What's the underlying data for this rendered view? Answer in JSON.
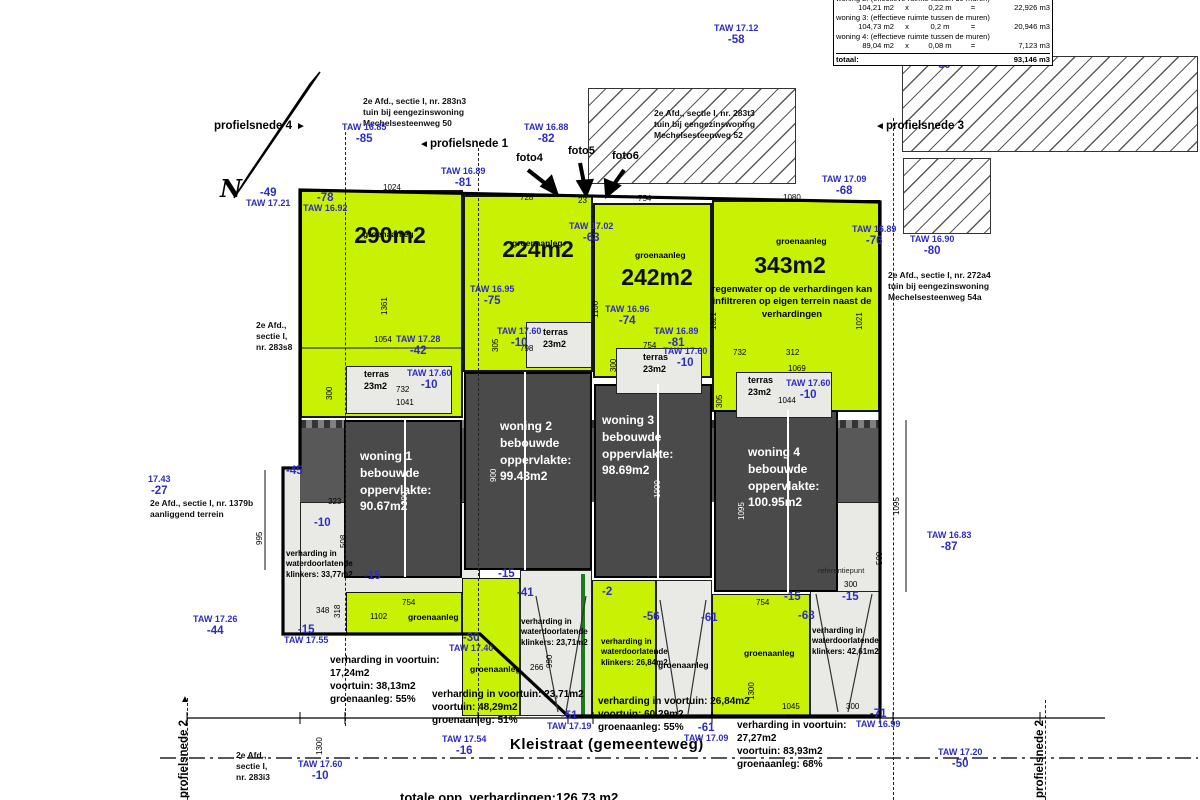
{
  "colors": {
    "parcel_green": "#c9f104",
    "building_gray": "#4a4a4a",
    "light_gray": "#e9e9e6",
    "annotation_blue": "#2d2dc2"
  },
  "summary_table": {
    "rows": [
      {
        "label": "woning 2:  (effectieve ruimte tussen de muren)"
      },
      {
        "a": "104,21 m2",
        "op": "x",
        "b": "0,22 m",
        "eq": "=",
        "v": "22,926 m3"
      },
      {
        "label": "woning 3:  (effectieve ruimte tussen de muren)"
      },
      {
        "a": "104,73 m2",
        "op": "x",
        "b": "0,2 m",
        "eq": "=",
        "v": "20,946 m3"
      },
      {
        "label": "woning 4:  (effectieve ruimte tussen de muren)"
      },
      {
        "a": "89,04 m2",
        "op": "x",
        "b": "0,08 m",
        "eq": "=",
        "v": "7,123 m3"
      }
    ],
    "total_label": "totaal:",
    "total_value": "93,146 m3"
  },
  "parcels": [
    {
      "label": "groenaanleg",
      "area": "290m2",
      "lx": 363,
      "ly": 229,
      "ax": 390,
      "ay": 222
    },
    {
      "label": "groenaanleg",
      "area": "224m2",
      "lx": 512,
      "ly": 238,
      "ax": 538,
      "ay": 236
    },
    {
      "label": "groenaanleg",
      "area": "242m2",
      "lx": 635,
      "ly": 250,
      "ax": 657,
      "ay": 264
    },
    {
      "label": "groenaanleg",
      "area": "343m2",
      "lx": 776,
      "ly": 236,
      "ax": 790,
      "ay": 252,
      "note": "regenwater op de verhardingen kan infiltreren op eigen terrein naast de verhardingen",
      "nx": 792,
      "ny": 284
    }
  ],
  "buildings": [
    {
      "lines": [
        "woning 1",
        "bebouwde",
        "oppervlakte:",
        "90.67m2"
      ],
      "tx": 360,
      "ty": 448
    },
    {
      "lines": [
        "woning 2",
        "bebouwde",
        "oppervlakte:",
        "99.43m2"
      ],
      "tx": 500,
      "ty": 418
    },
    {
      "lines": [
        "woning 3",
        "bebouwde",
        "oppervlakte:",
        "98.69m2"
      ],
      "tx": 602,
      "ty": 412
    },
    {
      "lines": [
        "woning 4",
        "bebouwde",
        "oppervlakte:",
        "100.95m2"
      ],
      "tx": 748,
      "ty": 444
    }
  ],
  "terraces": [
    {
      "label": "terras",
      "area": "23m2",
      "x": 364,
      "y": 368
    },
    {
      "label": "terras",
      "area": "23m2",
      "x": 543,
      "y": 326
    },
    {
      "label": "terras",
      "area": "23m2",
      "x": 643,
      "y": 351
    },
    {
      "label": "terras",
      "area": "23m2",
      "x": 748,
      "y": 374
    }
  ],
  "taw_markers": [
    {
      "taw": "TAW 17.12",
      "off": "-58",
      "x": 714,
      "y": 24
    },
    {
      "taw": "TAW 16.85",
      "off": "-85",
      "x": 342,
      "y": 123
    },
    {
      "taw": "TAW 16.88",
      "off": "-82",
      "x": 524,
      "y": 123
    },
    {
      "taw": "TAW 16.89",
      "off": "-81",
      "x": 441,
      "y": 167
    },
    {
      "taw": "TAW 17.21",
      "off": "-49",
      "x": 246,
      "y": 187,
      "flip": true
    },
    {
      "taw": "TAW 16.92",
      "off": "-78",
      "x": 303,
      "y": 192,
      "flip": true
    },
    {
      "taw": "TAW 17.09",
      "off": "-68",
      "x": 822,
      "y": 175
    },
    {
      "taw": "TAW 16.89",
      "off": "-76",
      "x": 852,
      "y": 225
    },
    {
      "taw": "TAW 16.90",
      "off": "-80",
      "x": 910,
      "y": 235
    },
    {
      "taw": "TAW 16.95",
      "off": "-75",
      "x": 470,
      "y": 285
    },
    {
      "taw": "TAW 17.02",
      "off": "-63",
      "x": 569,
      "y": 222
    },
    {
      "taw": "TAW 16.96",
      "off": "-74",
      "x": 605,
      "y": 305
    },
    {
      "taw": "TAW 16.89",
      "off": "-81",
      "x": 654,
      "y": 327
    },
    {
      "taw": "TAW 17.28",
      "off": "-42",
      "x": 396,
      "y": 335
    },
    {
      "taw": "17.43",
      "off": "-27",
      "x": 148,
      "y": 475
    },
    {
      "taw": "TAW 17.26",
      "off": "-44",
      "x": 193,
      "y": 615
    },
    {
      "taw": "TAW 17.55",
      "off": "-15",
      "x": 284,
      "y": 624,
      "flip": true
    },
    {
      "taw": "TAW 17.40",
      "off": "-30",
      "x": 449,
      "y": 632,
      "flip": true
    },
    {
      "taw": "TAW 17.19",
      "off": "-51",
      "x": 547,
      "y": 710,
      "flip": true
    },
    {
      "taw": "TAW 17.09",
      "off": "-61",
      "x": 684,
      "y": 722,
      "flip": true
    },
    {
      "taw": "TAW 16.99",
      "off": "-71",
      "x": 856,
      "y": 708,
      "flip": true
    },
    {
      "taw": "TAW 17.54",
      "off": "-16",
      "x": 442,
      "y": 735
    },
    {
      "taw": "TAW 16.83",
      "off": "-87",
      "x": 927,
      "y": 531
    },
    {
      "taw": "TAW 17.20",
      "off": "-50",
      "x": 938,
      "y": 748
    },
    {
      "taw": "TAW 17.60",
      "off": "-10",
      "x": 298,
      "y": 760
    },
    {
      "taw": "TAW 17.60",
      "off": "-10",
      "x": 407,
      "y": 369
    },
    {
      "taw": "TAW 17.60",
      "off": "-10",
      "x": 497,
      "y": 327
    },
    {
      "taw": "TAW 17.60",
      "off": "-10",
      "x": 663,
      "y": 347
    },
    {
      "taw": "TAW 17.60",
      "off": "-10",
      "x": 786,
      "y": 379
    }
  ],
  "offset_markers": [
    {
      "t": "-60",
      "x": 934,
      "y": 60
    },
    {
      "t": "-45",
      "x": 286,
      "y": 466
    },
    {
      "t": "-10",
      "x": 314,
      "y": 518
    },
    {
      "t": "-15",
      "x": 364,
      "y": 571
    },
    {
      "t": "-15",
      "x": 498,
      "y": 569
    },
    {
      "t": "-41",
      "x": 517,
      "y": 588
    },
    {
      "t": "-2",
      "x": 602,
      "y": 587
    },
    {
      "t": "-56",
      "x": 643,
      "y": 612
    },
    {
      "t": "-61",
      "x": 701,
      "y": 613
    },
    {
      "t": "-15",
      "x": 784,
      "y": 592
    },
    {
      "t": "-68",
      "x": 798,
      "y": 611
    },
    {
      "t": "-15",
      "x": 842,
      "y": 592
    }
  ],
  "dims": [
    {
      "t": "1024",
      "x": 383,
      "y": 184
    },
    {
      "t": "728",
      "x": 520,
      "y": 194
    },
    {
      "t": "23",
      "x": 578,
      "y": 197
    },
    {
      "t": "754",
      "x": 638,
      "y": 195
    },
    {
      "t": "1080",
      "x": 783,
      "y": 194
    },
    {
      "t": "1361",
      "x": 381,
      "y": 315,
      "r": 1
    },
    {
      "t": "1100",
      "x": 592,
      "y": 318,
      "r": 1
    },
    {
      "t": "1321",
      "x": 710,
      "y": 330,
      "r": 1
    },
    {
      "t": "1021",
      "x": 856,
      "y": 330,
      "r": 1
    },
    {
      "t": "1054",
      "x": 374,
      "y": 336
    },
    {
      "t": "732",
      "x": 396,
      "y": 386
    },
    {
      "t": "300",
      "x": 326,
      "y": 400,
      "r": 1
    },
    {
      "t": "1041",
      "x": 396,
      "y": 399
    },
    {
      "t": "798",
      "x": 520,
      "y": 345
    },
    {
      "t": "305",
      "x": 492,
      "y": 352,
      "r": 1
    },
    {
      "t": "754",
      "x": 643,
      "y": 342
    },
    {
      "t": "300",
      "x": 610,
      "y": 372,
      "r": 1
    },
    {
      "t": "732",
      "x": 733,
      "y": 349
    },
    {
      "t": "312",
      "x": 786,
      "y": 349
    },
    {
      "t": "1069",
      "x": 788,
      "y": 365
    },
    {
      "t": "1044",
      "x": 778,
      "y": 397
    },
    {
      "t": "305",
      "x": 716,
      "y": 408,
      "r": 1
    },
    {
      "t": "323",
      "x": 328,
      "y": 498
    },
    {
      "t": "508",
      "x": 340,
      "y": 548,
      "r": 1
    },
    {
      "t": "318",
      "x": 334,
      "y": 618,
      "r": 1
    },
    {
      "t": "348",
      "x": 316,
      "y": 607
    },
    {
      "t": "995",
      "x": 256,
      "y": 545,
      "r": 1
    },
    {
      "t": "1102",
      "x": 370,
      "y": 613
    },
    {
      "t": "754",
      "x": 402,
      "y": 599
    },
    {
      "t": "266",
      "x": 530,
      "y": 664
    },
    {
      "t": "990",
      "x": 546,
      "y": 668,
      "r": 1
    },
    {
      "t": "754",
      "x": 756,
      "y": 599
    },
    {
      "t": "300",
      "x": 844,
      "y": 581
    },
    {
      "t": "1045",
      "x": 782,
      "y": 703
    },
    {
      "t": "300",
      "x": 846,
      "y": 703
    },
    {
      "t": "1300",
      "x": 748,
      "y": 700,
      "r": 1
    },
    {
      "t": "1300",
      "x": 316,
      "y": 755,
      "r": 1
    },
    {
      "t": "1095",
      "x": 893,
      "y": 515,
      "r": 1
    },
    {
      "t": "500",
      "x": 876,
      "y": 565,
      "r": 1
    },
    {
      "t": "990",
      "x": 401,
      "y": 505,
      "r": 1,
      "w": 1
    },
    {
      "t": "900",
      "x": 490,
      "y": 482,
      "r": 1,
      "w": 1
    },
    {
      "t": "1000",
      "x": 654,
      "y": 498,
      "r": 1,
      "w": 1
    },
    {
      "t": "1095",
      "x": 738,
      "y": 520,
      "r": 1,
      "w": 1
    }
  ],
  "cadastre": [
    {
      "lines": [
        "2e Afd., sectie I, nr. 283n3",
        "tuin bij eengezinswoning",
        "Mechelsesteenweg 50"
      ],
      "x": 363,
      "y": 96
    },
    {
      "lines": [
        "2e Afd., sectie I, nr. 283t3",
        "tuin bij eengezinswoning",
        "Mechelsesteenweg 52"
      ],
      "x": 654,
      "y": 108
    },
    {
      "lines": [
        "2e Afd., sectie I, nr. 272a4",
        "tuin bij eengezinswoning",
        "Mechelsesteenweg 54a"
      ],
      "x": 888,
      "y": 270
    },
    {
      "lines": [
        "2e Afd.,",
        "sectie I,",
        "nr. 283s8"
      ],
      "x": 256,
      "y": 320
    },
    {
      "lines": [
        "2e Afd., sectie I, nr. 1379b",
        "aanliggend terrein"
      ],
      "x": 150,
      "y": 498
    },
    {
      "lines": [
        "2e Afd.,",
        "sectie I,",
        "nr. 283i3"
      ],
      "x": 236,
      "y": 750
    }
  ],
  "notes": [
    {
      "lines": [
        "verharding in",
        "waterdoorlatende",
        "klinkers:  33,77m2"
      ],
      "x": 286,
      "y": 549,
      "s": 8
    },
    {
      "lines": [
        "verharding in voortuin:",
        "17,24m2",
        "voortuin:  38,13m2",
        "groenaanleg:  55%"
      ],
      "x": 330,
      "y": 654,
      "s": 10
    },
    {
      "lines": [
        "verharding in voortuin: 23,71m2",
        "voortuin:  48,29m2",
        "groenaanleg:  51%"
      ],
      "x": 432,
      "y": 688,
      "s": 10
    },
    {
      "lines": [
        "verharding in",
        "waterdoorlatende",
        "klinkers:  23,71m2"
      ],
      "x": 521,
      "y": 617,
      "s": 8
    },
    {
      "lines": [
        "verharding in",
        "waterdoorlatende",
        "klinkers:  26,84m2"
      ],
      "x": 601,
      "y": 637,
      "s": 8
    },
    {
      "lines": [
        "verharding in voortuin: 26,84m2",
        "voortuin:  60,29m2",
        "groenaanleg:  55%"
      ],
      "x": 598,
      "y": 695,
      "s": 10
    },
    {
      "lines": [
        "verharding in",
        "waterdoorlatende",
        "klinkers:  42,61m2"
      ],
      "x": 812,
      "y": 626,
      "s": 8
    },
    {
      "lines": [
        "verharding in voortuin:",
        "27,27m2",
        "voortuin:  83,93m2",
        "groenaanleg:  68%"
      ],
      "x": 737,
      "y": 719,
      "s": 10
    }
  ],
  "green_labels": [
    {
      "t": "groenaanleg",
      "x": 408,
      "y": 612
    },
    {
      "t": "groenaanleg",
      "x": 470,
      "y": 664
    },
    {
      "t": "groenaanleg",
      "x": 658,
      "y": 660
    },
    {
      "t": "groenaanleg",
      "x": 744,
      "y": 648
    }
  ],
  "profiles": [
    {
      "label": "profielsnede 4",
      "x": 214,
      "y": 120,
      "arrow": "right",
      "axx": 296,
      "ay": 121
    },
    {
      "label": "profielsnede 1",
      "x": 430,
      "y": 138,
      "arrow": "left",
      "axx": 419,
      "ay": 139
    },
    {
      "label": "profielsnede 3",
      "x": 886,
      "y": 120,
      "arrow": "left",
      "axx": 875,
      "ay": 121
    },
    {
      "label": "profielsnede 2",
      "x": 178,
      "y": 798,
      "rot": true,
      "arrow": "up",
      "axx": 180,
      "ay": 694
    },
    {
      "label": "profielsnede 2",
      "x": 1034,
      "y": 798,
      "rot": true
    }
  ],
  "photos": [
    {
      "label": "foto4",
      "x": 516,
      "y": 152
    },
    {
      "label": "foto5",
      "x": 568,
      "y": 145
    },
    {
      "label": "foto6",
      "x": 612,
      "y": 150
    }
  ],
  "street": {
    "label": "Kleistraat (gemeenteweg)"
  },
  "bottom_note": {
    "label": "totale opp. verhardingen:126,73 m2"
  },
  "north": {
    "label": "N"
  },
  "ref_point": {
    "label": "referentiepunt"
  },
  "icons": {
    "arrow_left": "◄",
    "arrow_right": "►",
    "arrow_up": "▲"
  }
}
